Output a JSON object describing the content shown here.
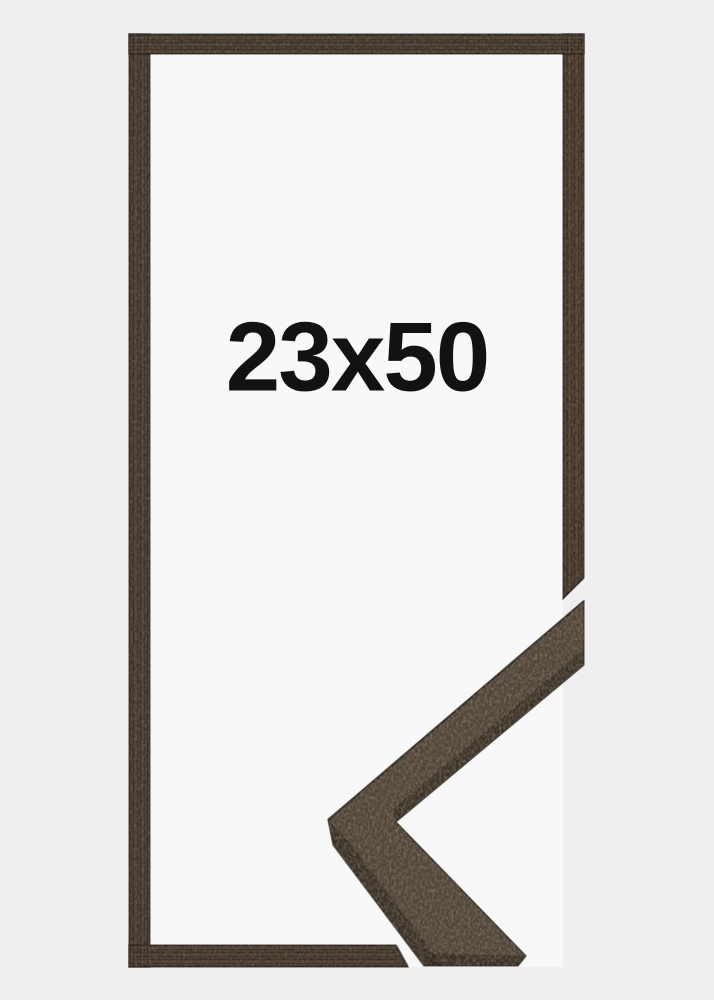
{
  "product": {
    "size_label": "23x50"
  },
  "colors": {
    "bg": "#efeff1",
    "interior": "#f8f8f9",
    "wood-base": "#46392e",
    "wood-face": "#52463a",
    "wood-dark": "#352d25",
    "label": "#121212"
  }
}
